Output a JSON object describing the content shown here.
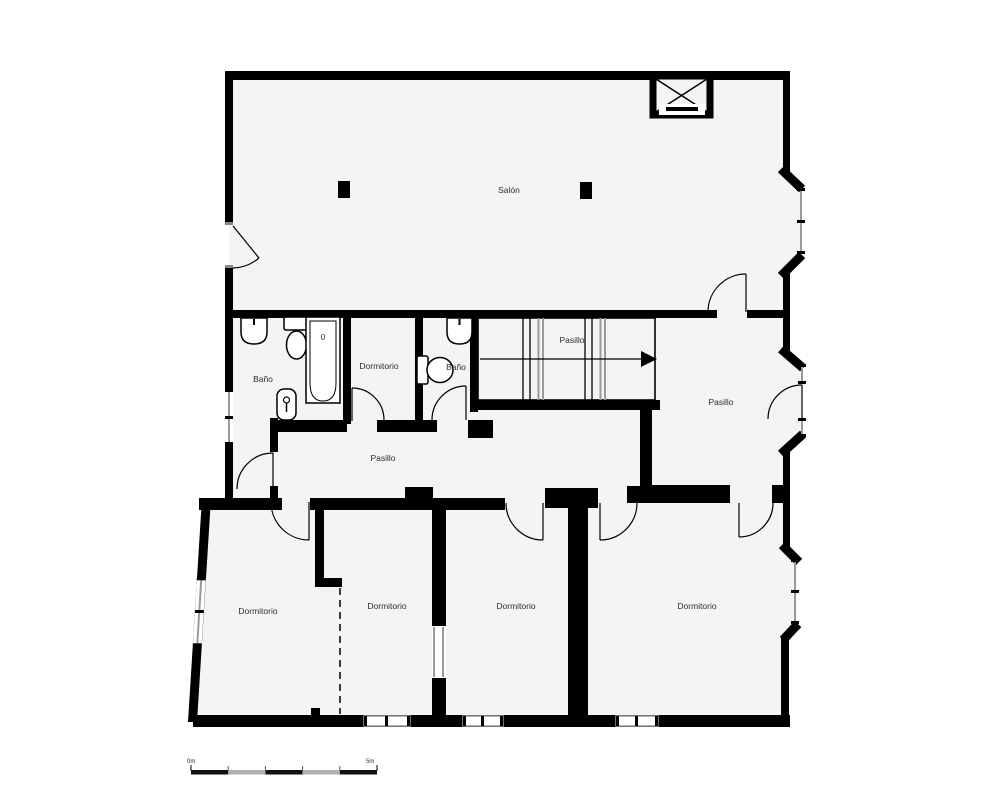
{
  "floor_plan": {
    "rooms": {
      "salon": "Salón",
      "bano_left": "Baño",
      "dormitorio_small": "Dormitorio",
      "bano_right": "Baño",
      "pasillo_stairs": "Pasillo",
      "pasillo_right": "Pasillo",
      "pasillo_center": "Pasillo",
      "dormitorio_sw": "Dormitorio",
      "dormitorio_s2": "Dormitorio",
      "dormitorio_s3": "Dormitorio",
      "dormitorio_se": "Dormitorio"
    },
    "bathtub_mark": "0",
    "scale_bar": {
      "start": "0m",
      "end": "5m"
    },
    "stairs_direction": "right",
    "icons": [
      "bathtub-icon",
      "toilet-icon",
      "sink-icon",
      "bidet-icon",
      "stairs-icon",
      "elevator-shaft-icon",
      "door-arc-icon",
      "column-icon",
      "window-icon",
      "scale-bar-icon"
    ],
    "colors": {
      "wall": "#000000",
      "floor": "#f4f4f4",
      "background": "#ffffff",
      "window_glass": "#9a9a9a",
      "scale_alt": "#b0b0b0"
    }
  }
}
